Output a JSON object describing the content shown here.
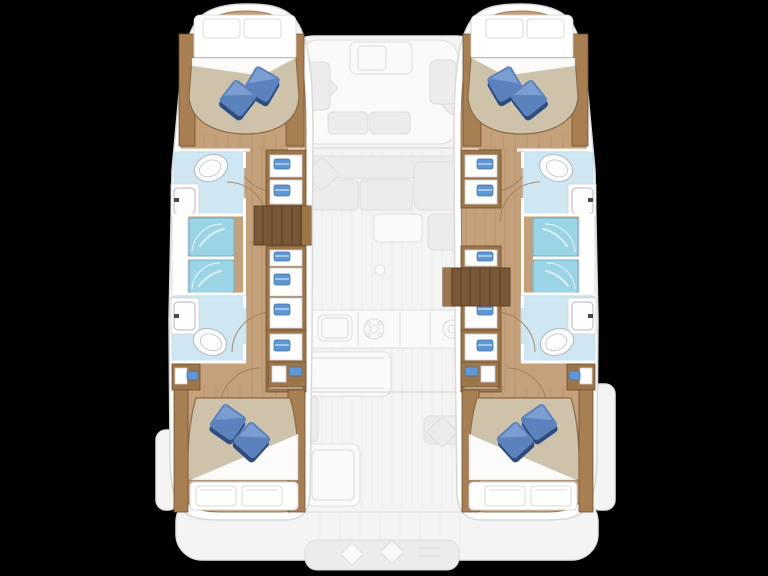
{
  "figure": {
    "title": "Catamaran deck floor plan",
    "type": "floor-plan",
    "view": "top-down",
    "background_color": "#000000"
  },
  "palette": {
    "deck_faded": "#f4f4f4",
    "deck_outline": "#e3e3e3",
    "furniture_faded": "#ececec",
    "hull_trim_white": "#ffffff",
    "wood_floor": "#c4a17a",
    "wood_furniture": "#a87f52",
    "wood_dark": "#7a5737",
    "mattress": "#cec2aa",
    "mattress_edge": "#8a6a46",
    "pillow_blue": "#5c82bd",
    "pillow_blue_light": "#88aad8",
    "pillow_blue_dark": "#2d4c80",
    "linen_white": "#ffffff",
    "shower_blue": "#9bd4e7",
    "bathroom_floor": "#cfe7f2",
    "fixture_white": "#fdfdfd",
    "shelf_item_blue": "#5e97d3"
  },
  "vessel": {
    "hull_count": 2,
    "counts": {
      "cabins": 4,
      "heads": 4,
      "shower_stalls": 4,
      "double_berths": 4
    },
    "hulls": [
      {
        "name": "port-hull",
        "side": "left",
        "rooms": [
          {
            "name": "forward-cabin",
            "furniture": [
              "double-berth",
              "white-pillows",
              "blue-pillows",
              "side-lockers"
            ]
          },
          {
            "name": "forward-head",
            "fixtures": [
              "toilet",
              "washbasin",
              "shower-stall"
            ]
          },
          {
            "name": "aft-head",
            "fixtures": [
              "toilet",
              "washbasin",
              "shower-stall"
            ]
          },
          {
            "name": "corridor",
            "features": [
              "doors",
              "storage-lockers"
            ]
          },
          {
            "name": "aft-cabin",
            "furniture": [
              "double-berth",
              "white-pillows",
              "blue-pillows",
              "bedside-units"
            ]
          },
          {
            "name": "companionway-steps"
          }
        ]
      },
      {
        "name": "starboard-hull",
        "side": "right",
        "rooms": [
          {
            "name": "forward-cabin",
            "furniture": [
              "double-berth",
              "white-pillows",
              "blue-pillows",
              "side-lockers"
            ]
          },
          {
            "name": "forward-head",
            "fixtures": [
              "toilet",
              "washbasin",
              "shower-stall"
            ]
          },
          {
            "name": "aft-head",
            "fixtures": [
              "toilet",
              "washbasin",
              "shower-stall"
            ]
          },
          {
            "name": "corridor",
            "features": [
              "doors",
              "storage-lockers"
            ]
          },
          {
            "name": "aft-cabin",
            "furniture": [
              "double-berth",
              "white-pillows",
              "blue-pillows",
              "bedside-units"
            ]
          },
          {
            "name": "companionway-steps"
          }
        ]
      }
    ],
    "center_deck": {
      "style": "faded",
      "areas": [
        {
          "name": "foredeck-cockpit",
          "furniture": [
            "table",
            "u-shaped-seating",
            "diamond-cushions"
          ]
        },
        {
          "name": "salon",
          "furniture": [
            "sofa",
            "corner-seat",
            "chaise",
            "diamond-cushions",
            "table"
          ]
        },
        {
          "name": "galley",
          "fixtures": [
            "sink",
            "stove-burner",
            "round-hob",
            "island-counter"
          ]
        },
        {
          "name": "aft-cockpit",
          "furniture": [
            "table",
            "l-shaped-seating",
            "diamond-cushions",
            "side-bench"
          ]
        },
        {
          "name": "stern-platform",
          "furniture": [
            "stern-bench"
          ]
        }
      ]
    }
  }
}
